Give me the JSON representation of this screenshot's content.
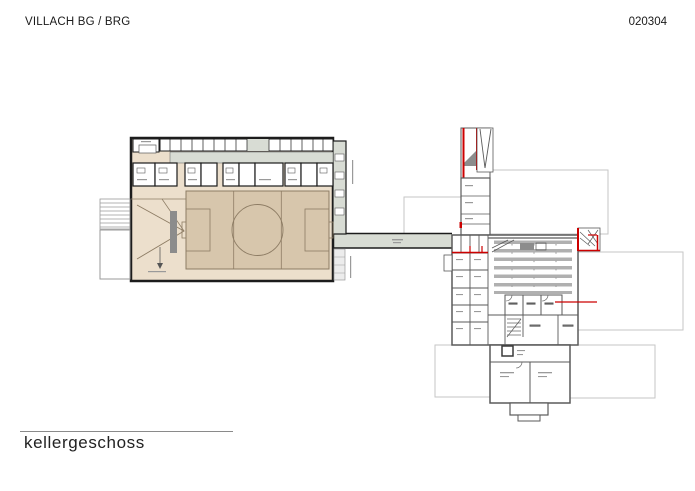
{
  "page": {
    "title": "VILLACH BG / BRG",
    "drawing_number": "020304",
    "floor_label": "kellergeschoss"
  },
  "colors": {
    "background": "#ffffff",
    "wall_dark": "#1c1c1c",
    "wall_gray": "#5a5a5a",
    "hall_floor": "#ecdfcc",
    "court_fill": "#d7c6ac",
    "court_line": "#8d7c64",
    "corridor_fill": "#d8dcd4",
    "accent_red": "#cc0000",
    "faint_outline": "#c6c6c6",
    "shelving_gray": "#b0b0b0",
    "stair_gray": "#8c8c8c",
    "text": "#1a1a1a"
  }
}
